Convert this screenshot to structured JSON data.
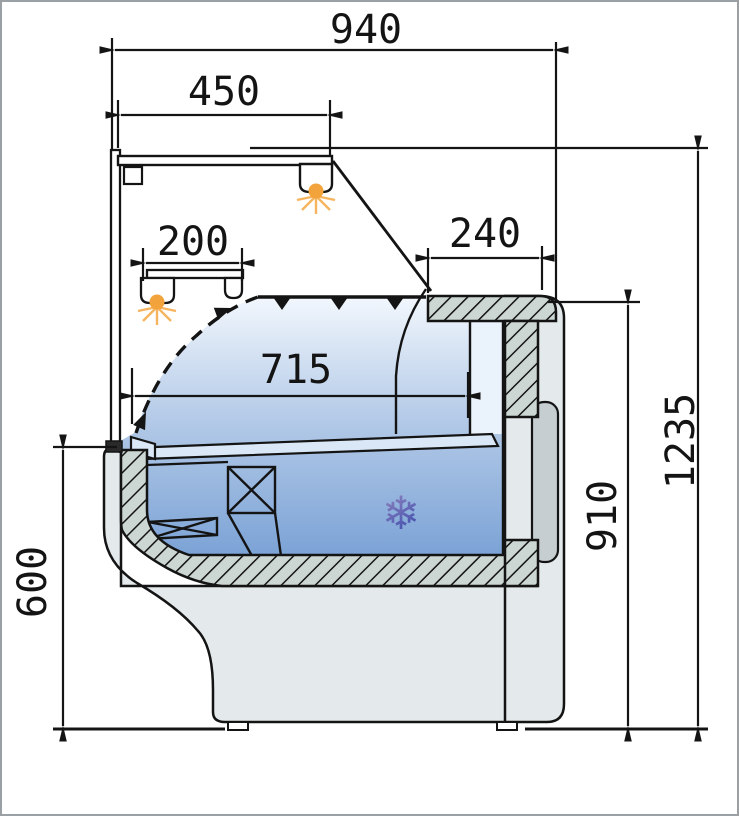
{
  "figure": {
    "kind": "technical cross-section drawing",
    "subject": "Refrigerated serve-over display counter, side section with dimensions",
    "units": "mm"
  },
  "dimensions": {
    "overall_width": "940",
    "canopy_depth": "450",
    "shelf_depth": "200",
    "rear_worktop_depth": "240",
    "display_deck_depth": "715",
    "overall_height": "1235",
    "rear_worktop_height": "910",
    "front_sill_height": "600"
  },
  "symbols": {
    "snowflake_glyph": "❄",
    "snowflake_meaning": "refrigerated zone",
    "lamp_icon_count": 2,
    "airflow": "air-curtain arrow path"
  },
  "colors": {
    "line": "#141414",
    "casing_gray": "#e4e9eb",
    "panel_gray": "#c6ced2",
    "hatch_fill": "#ccd6d2",
    "interior_blue_top": "#f2f7fd",
    "interior_blue_bottom": "#79a1d5",
    "lamp_orange": "#f3a33c",
    "snowflake_blue": "#4b51a6",
    "border_gray": "#9aa0a4"
  }
}
